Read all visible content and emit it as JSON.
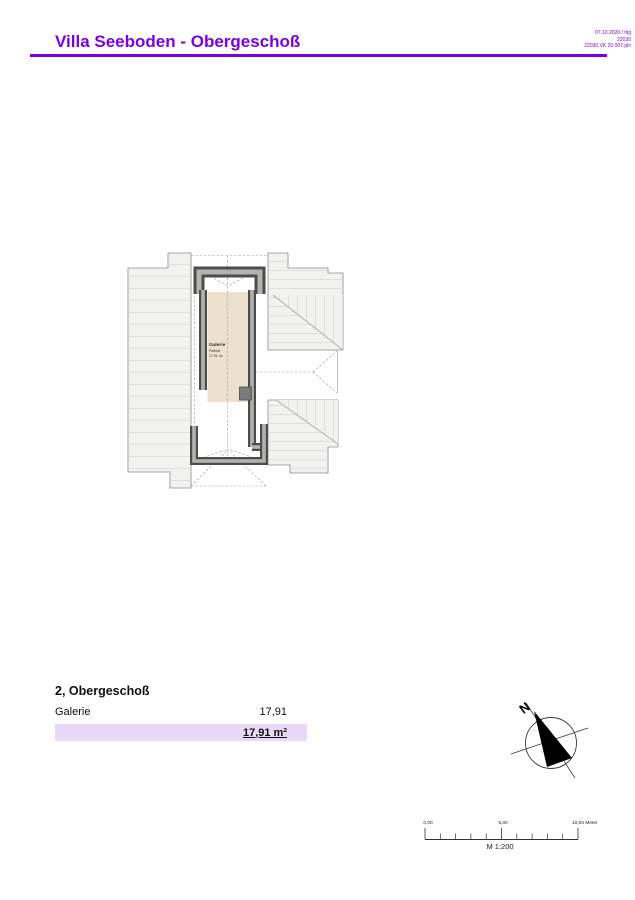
{
  "header": {
    "title": "Villa Seeboden - Obergeschoß",
    "meta": [
      "07.10.2020 / hlg",
      "22030",
      "22030 VK 20 007.pln"
    ]
  },
  "plan": {
    "room": {
      "name": "Galerie",
      "floor": "Parkett",
      "area": "17,91 m²"
    }
  },
  "summary": {
    "heading": "2, Obergeschoß",
    "rows": [
      {
        "label": "Galerie",
        "value": "17,91"
      }
    ],
    "total_value": "17,91 m²"
  },
  "compass": {
    "north": "N"
  },
  "scalebar": {
    "labels": [
      "0,00",
      "5,00",
      "10,00 Meter"
    ],
    "scale": "M 1:200"
  },
  "colors": {
    "accent_purple": "#7d00e0",
    "total_band": "#e8d9f8",
    "room_fill": "#ece1cf",
    "roof_fill": "#f2f2f1",
    "wall_dark": "#4d4d4d",
    "wall_light": "#b3b3b0"
  }
}
